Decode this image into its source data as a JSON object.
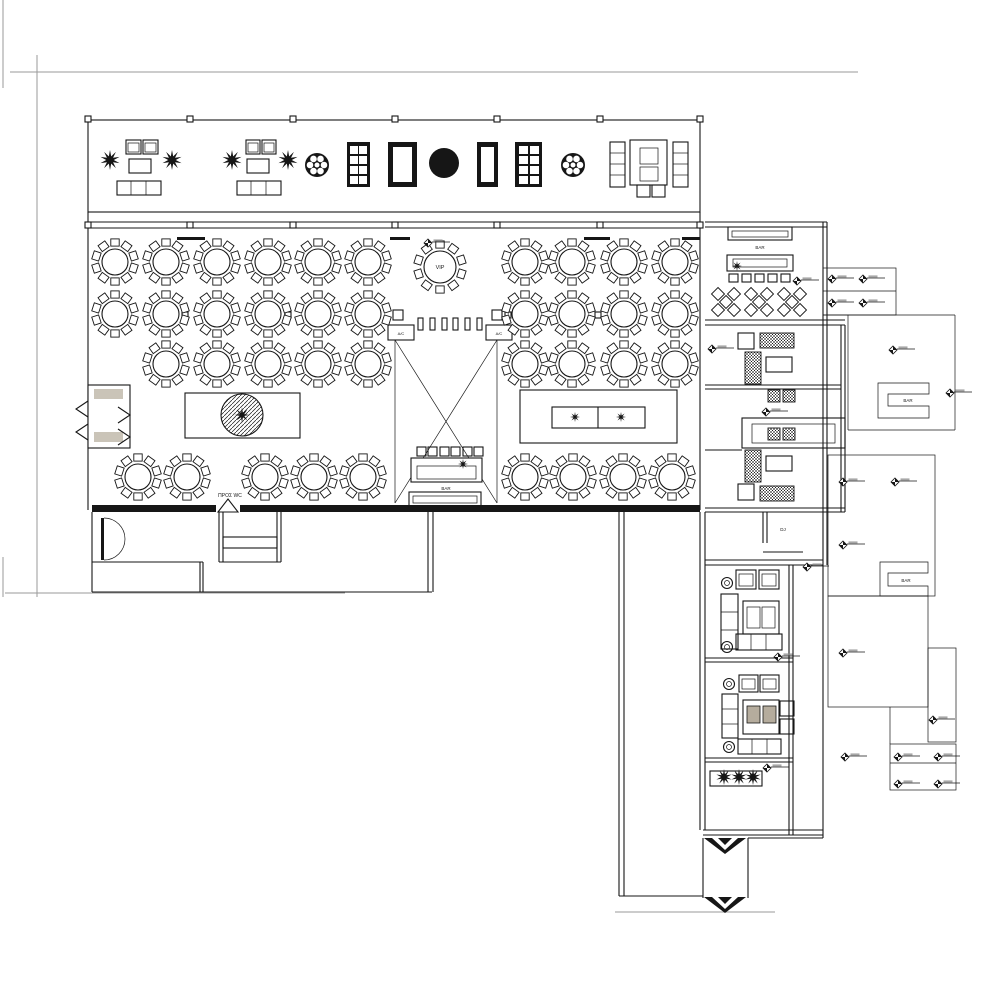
{
  "labels": {
    "vip": "VIP",
    "dj": "DJ",
    "to_wc": "ΠΡΟΣ WC",
    "bar_stage": "BAR",
    "bar_wing": "BAR",
    "bar_annex_upper": "BAR",
    "bar_annex_lower": "BAR",
    "ac_left": "A/C",
    "ac_right": "A/C"
  },
  "colors": {
    "line": "#161616",
    "reference_line": "#9a9a9a",
    "entry_mat": "#cac4b8",
    "cushion": "#b5ac9d"
  },
  "seating": {
    "seats_per_round_table": 10,
    "round_tables": [
      [
        115,
        262
      ],
      [
        166,
        262
      ],
      [
        217,
        262
      ],
      [
        268,
        262
      ],
      [
        318,
        262
      ],
      [
        368,
        262
      ],
      [
        525,
        262
      ],
      [
        572,
        262
      ],
      [
        624,
        262
      ],
      [
        675,
        262
      ],
      [
        115,
        314
      ],
      [
        166,
        314
      ],
      [
        217,
        314
      ],
      [
        268,
        314
      ],
      [
        318,
        314
      ],
      [
        368,
        314
      ],
      [
        525,
        314
      ],
      [
        572,
        314
      ],
      [
        624,
        314
      ],
      [
        675,
        314
      ],
      [
        166,
        364
      ],
      [
        217,
        364
      ],
      [
        268,
        364
      ],
      [
        318,
        364
      ],
      [
        368,
        364
      ],
      [
        525,
        364
      ],
      [
        572,
        364
      ],
      [
        624,
        364
      ],
      [
        675,
        364
      ],
      [
        138,
        477
      ],
      [
        187,
        477
      ],
      [
        265,
        477
      ],
      [
        314,
        477
      ],
      [
        363,
        477
      ],
      [
        525,
        477
      ],
      [
        573,
        477
      ],
      [
        623,
        477
      ],
      [
        672,
        477
      ]
    ],
    "vip_table": [
      440,
      267
    ],
    "wheel_tables": [
      [
        317,
        165
      ],
      [
        573,
        165
      ]
    ],
    "diamond_table_clusters": [
      [
        726,
        302
      ],
      [
        759,
        302
      ],
      [
        792,
        302
      ]
    ]
  },
  "symbols": {
    "elevation_markers": [
      [
        428,
        243
      ],
      [
        797,
        281
      ],
      [
        832,
        279
      ],
      [
        863,
        279
      ],
      [
        832,
        303
      ],
      [
        863,
        303
      ],
      [
        712,
        349
      ],
      [
        893,
        350
      ],
      [
        950,
        393
      ],
      [
        766,
        412
      ],
      [
        843,
        482
      ],
      [
        895,
        482
      ],
      [
        843,
        545
      ],
      [
        807,
        567
      ],
      [
        778,
        657
      ],
      [
        843,
        653
      ],
      [
        933,
        720
      ],
      [
        767,
        768
      ],
      [
        845,
        757
      ],
      [
        898,
        757
      ],
      [
        938,
        757
      ],
      [
        898,
        784
      ],
      [
        938,
        784
      ]
    ],
    "planters_top": [
      [
        110,
        160
      ],
      [
        172,
        160
      ],
      [
        232,
        160
      ],
      [
        288,
        160
      ]
    ],
    "planters_bottom": [
      [
        724,
        777
      ],
      [
        739,
        777
      ],
      [
        753,
        777
      ]
    ],
    "decor_stars": [
      [
        737,
        266,
        5
      ],
      [
        463,
        464,
        5
      ],
      [
        575,
        417,
        5
      ],
      [
        621,
        417,
        5
      ],
      [
        242,
        415,
        7.5
      ]
    ]
  }
}
